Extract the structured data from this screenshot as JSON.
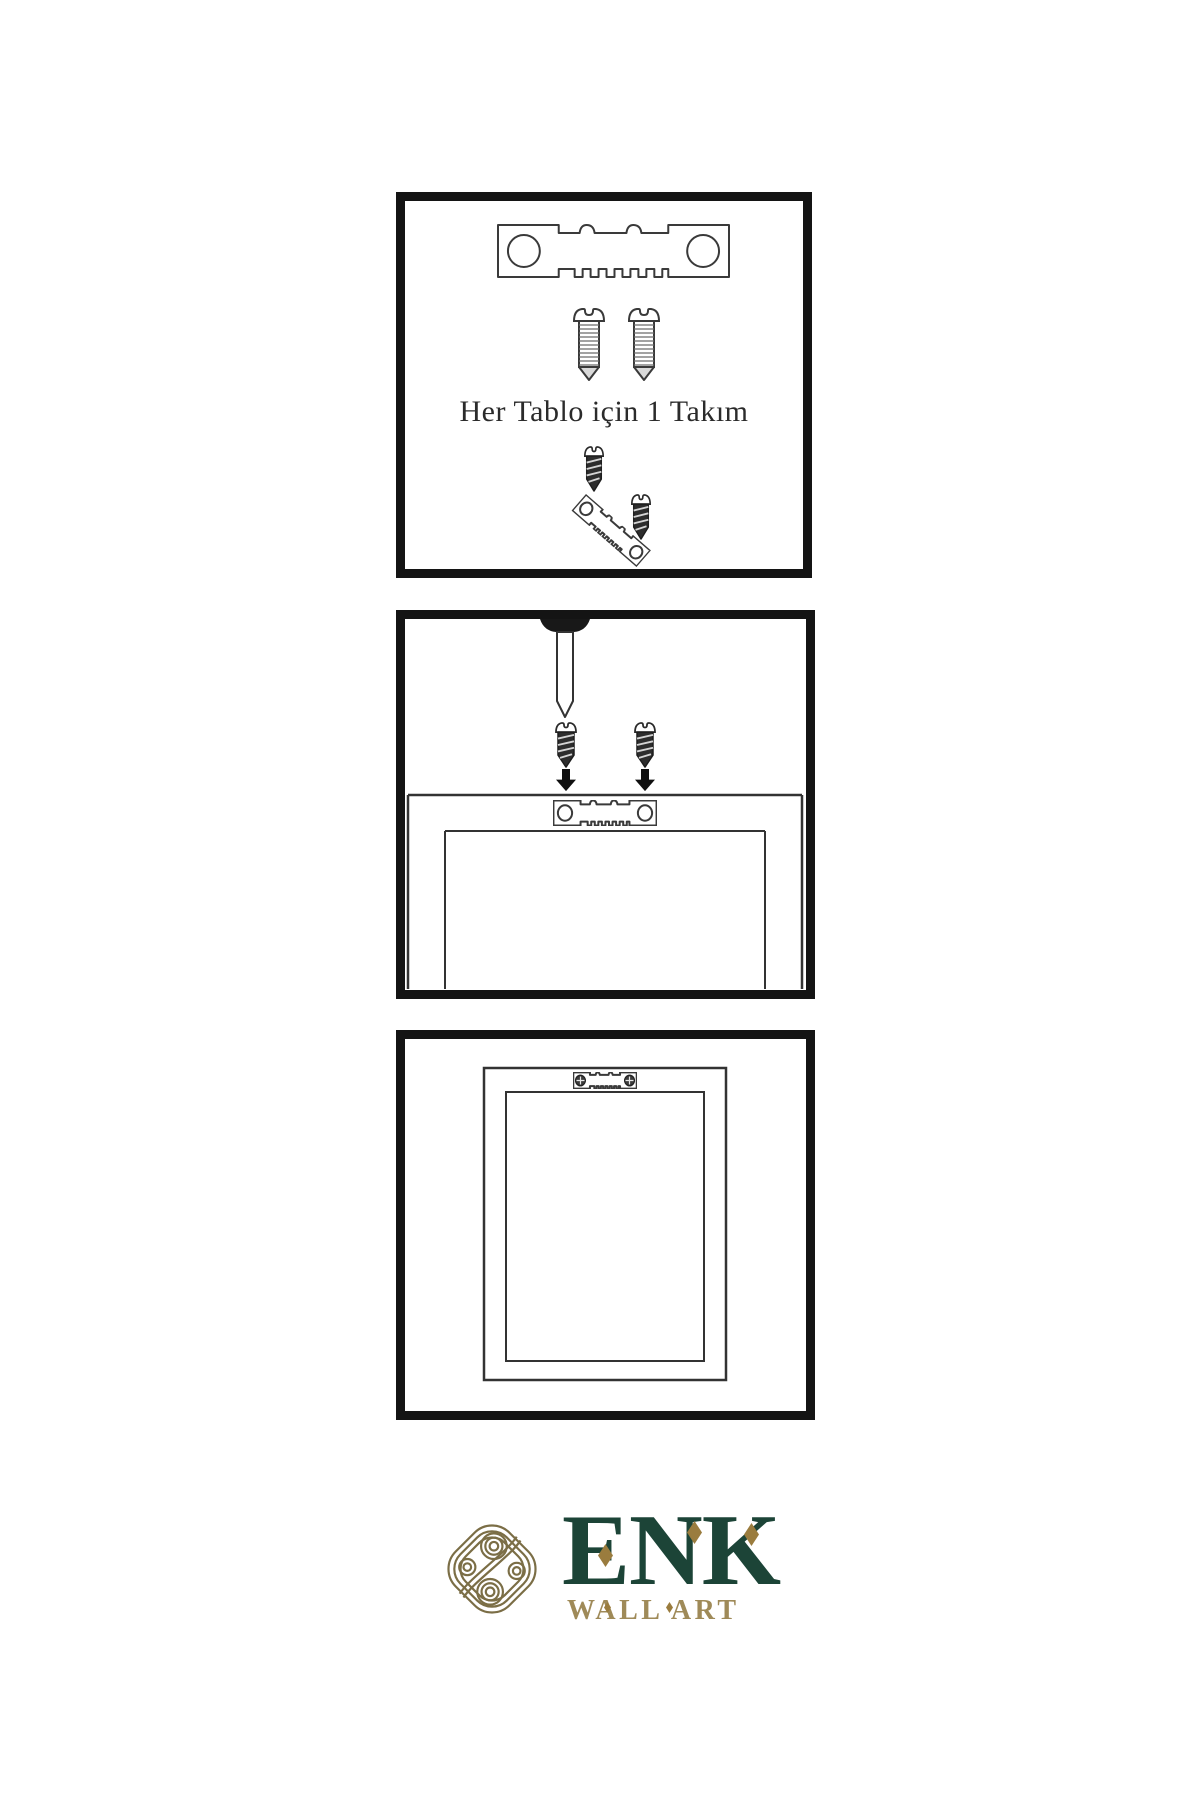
{
  "page": {
    "background_color": "#ffffff"
  },
  "step_panels": {
    "panel_count": 3,
    "border_color": "#141414",
    "line_color": "#3a3a3a",
    "step1": {
      "note": "Her Tablo için 1 Takım",
      "icons": [
        "sawtooth-hanger-icon",
        "screw-icon",
        "screw-icon",
        "screw-into-hanger-icon"
      ]
    },
    "step2": {
      "icons": [
        "wall-nail-icon",
        "screw-icon",
        "screw-icon",
        "down-arrow-icon",
        "down-arrow-icon",
        "frame-back-icon",
        "sawtooth-hanger-icon"
      ]
    },
    "step3": {
      "icons": [
        "frame-back-icon",
        "mounted-sawtooth-hanger-icon"
      ]
    }
  },
  "brand": {
    "name": "ENK",
    "tagline": "WALL ART",
    "name_color": "#1c4437",
    "tagline_color": "#9f8a58",
    "diamond_color": "#9a7c3e",
    "knot_color": "#7b6e46"
  }
}
